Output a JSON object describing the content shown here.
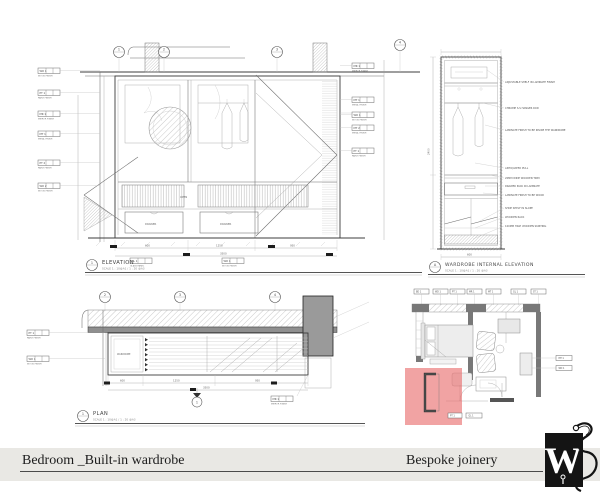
{
  "footer": {
    "title": "Bedroom _Built-in wardrobe",
    "right_label": "Bespoke joinery",
    "logo_letter": "W",
    "band_color": "#e9e8e4"
  },
  "colors": {
    "highlight": "#e96a6a",
    "wall_dark": "#8f8f8f",
    "keyplan_wall": "#787878"
  },
  "elevation": {
    "ref": "1",
    "title": "ELEVATION",
    "scale": "SCALE 1 : 10@A1 / 1 : 20 @A3",
    "grid_bubbles": [
      "1",
      "2",
      "3",
      "4"
    ],
    "left_tags": [
      {
        "code": "WD 1",
        "caption": "WOOD FINISH"
      },
      {
        "code": "PT 1",
        "caption": "PAINT FINISH"
      },
      {
        "code": "MR 1",
        "caption": "MIRROR FINISH"
      },
      {
        "code": "MT 1",
        "caption": "METAL FINISH"
      },
      {
        "code": "PT 2",
        "caption": "PAINT FINISH"
      },
      {
        "code": "WD 2",
        "caption": "WOOD FINISH"
      }
    ],
    "right_tags": [
      {
        "code": "MR 1",
        "caption": "MIRROR FINISH"
      },
      {
        "code": "MT 1",
        "caption": "METAL FINISH"
      },
      {
        "code": "WD 1",
        "caption": "WOOD FINISH"
      },
      {
        "code": "MT 2",
        "caption": "METAL FINISH"
      },
      {
        "code": "PT 1",
        "caption": "PAINT FINISH"
      }
    ],
    "bottom_tags": [
      {
        "code": "GL 1",
        "caption": "GLASS PANEL"
      },
      {
        "code": "WD 1",
        "caption": "WOOD FINISH"
      }
    ],
    "drawer_label": "DRAWER",
    "open_label": "OPEN",
    "dims": [
      "600",
      "1250",
      "950",
      "3500"
    ]
  },
  "internal": {
    "ref": "A",
    "title": "WARDROBE INTERNAL ELEVATION",
    "scale": "SCALE 1 : 10@A1 / 1 : 20 @A3",
    "annotations": [
      "ADJUSTABLE SHELF IN LAMINATE FINISH",
      "CHROME S.S HANGER ROD",
      "LAMINATE FINISH TO BE INSIDE THE WARDROBE",
      "ANTIQUATED PULL",
      "20MM WIDE WOODEN TRIM",
      "DRAWER PACK IN LAMINATE",
      "LAMINATE FINISH TO BE WOOD",
      "SHOE SHELF IN SLOPE",
      "WOODEN RACK",
      "100MM HIGH WOODEN SKIRTING"
    ],
    "dims": [
      "2400",
      "600"
    ]
  },
  "plan": {
    "ref": "1",
    "title": "PLAN",
    "scale": "SCALE 1 : 10@A1 / 1 : 20 @A3",
    "grid_bubbles": [
      "2",
      "3",
      "4"
    ],
    "left_tags": [
      {
        "code": "PT 1",
        "caption": "PAINT FINISH"
      },
      {
        "code": "WD 1",
        "caption": "WOOD FINISH"
      }
    ],
    "bottom_tag": {
      "code": "MR 1",
      "caption": "MIRROR FINISH"
    },
    "interior_label": "WARDROBE",
    "dims": [
      "600",
      "1250",
      "950",
      "3500"
    ]
  },
  "keyplan": {
    "top_tags": [
      "BD 1",
      "WD 1",
      "PT 1",
      "MR 1",
      "MT 1",
      "GL 1",
      "ST 1"
    ],
    "right_tags": [
      "MT 1",
      "WD 1"
    ],
    "bottom_tags": [
      "PT 1",
      "GL 1"
    ]
  }
}
